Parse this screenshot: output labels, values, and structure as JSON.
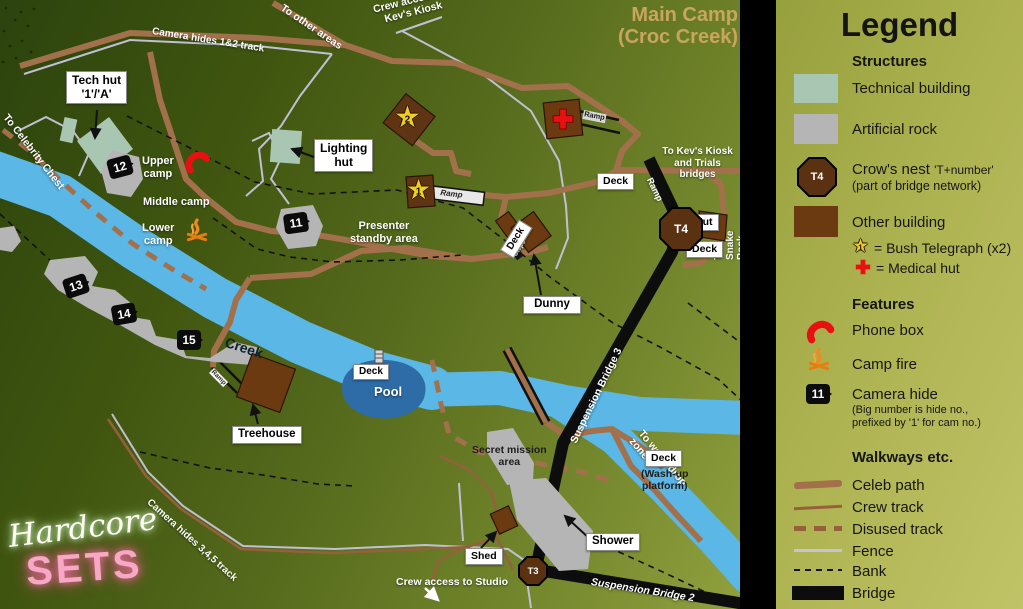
{
  "colors": {
    "creek": "#5bb7e6",
    "pool": "#2e6ca8",
    "celeb_path": "#a2714b",
    "crew_track": "#96603c",
    "fence": "#c0c0d2",
    "bridge": "#0d0d0d",
    "technical_building": "#a9c6b2",
    "artificial_rock": "#b5b5b5",
    "other_building": "#6b3a10",
    "crows_nest": "#5a3212",
    "phone": "#e81010",
    "fire": "#f08a1d",
    "star": "#f2cf1f",
    "title_gold": "#c9a55e"
  },
  "map": {
    "title_line1": "Main Camp",
    "title_line2": "(Croc Creek)",
    "annotations": {
      "camera_track_12": "Camera hides 1&2 track",
      "to_other_areas": "To other areas",
      "crew_access_kiosk": "Crew access to\nKev's Kiosk",
      "to_celebrity_chest": "To Celebrity Chest",
      "upper_camp": "Upper\ncamp",
      "middle_camp": "Middle camp",
      "lower_camp": "Lower\ncamp",
      "presenter": "Presenter\nstandby area",
      "to_kevs_kiosk": "To Kev's Kiosk\nand Trials bridges",
      "to_snake_rock": "To Snake Rock",
      "sb3": "Suspension Bridge 3",
      "sb2": "Suspension Bridge 2",
      "ramp": "Ramp",
      "steps": "Steps",
      "to_wood_drop": "To wood drop zone",
      "crew_access_studio": "Crew access to Studio",
      "camera_track_345": "Camera hides 3,4,5 track",
      "creek": "Creek",
      "pool": "Pool",
      "secret_mission": "Secret mission\narea",
      "washup": "(Wash-up\nplatform)"
    },
    "labels": {
      "tech_hut": "Tech hut\n'1'/'A'",
      "lighting_hut": "Lighting\nhut",
      "deck": "Deck",
      "hut": "Hut",
      "dunny": "Dunny",
      "treehouse": "Treehouse",
      "shower": "Shower",
      "shed": "Shed"
    },
    "camera_hides": {
      "h12": "12",
      "h11": "11",
      "h13": "13",
      "h14": "14",
      "h15": "15"
    },
    "crows_nests": {
      "t4": "T4",
      "t3": "T3"
    },
    "bush_telegraphs": {
      "bt2": "2",
      "bt1": "1"
    }
  },
  "logo": {
    "script": "Hardcore",
    "block": "SETS"
  },
  "legend": {
    "title": "Legend",
    "structures_heading": "Structures",
    "technical_building": "Technical building",
    "artificial_rock": "Artificial rock",
    "crows_nest_label": "Crow's nest",
    "crows_nest_suffix": "'T+number'",
    "crows_nest_note": "(part of bridge network)",
    "crows_nest_icon": "T4",
    "other_building": "Other building",
    "bush_telegraph": "= Bush Telegraph (x2)",
    "bush_telegraph_num": "1",
    "medical_hut": "= Medical hut",
    "features_heading": "Features",
    "phone_box": "Phone box",
    "camp_fire": "Camp fire",
    "camera_hide": "Camera hide",
    "camera_hide_icon": "11",
    "camera_hide_note": "(Big number is hide no.,\nprefixed by '1' for cam no.)",
    "walkways_heading": "Walkways etc.",
    "celeb_path": "Celeb path",
    "crew_track": "Crew track",
    "disused_track": "Disused track",
    "fence": "Fence",
    "bank": "Bank",
    "bridge": "Bridge"
  }
}
